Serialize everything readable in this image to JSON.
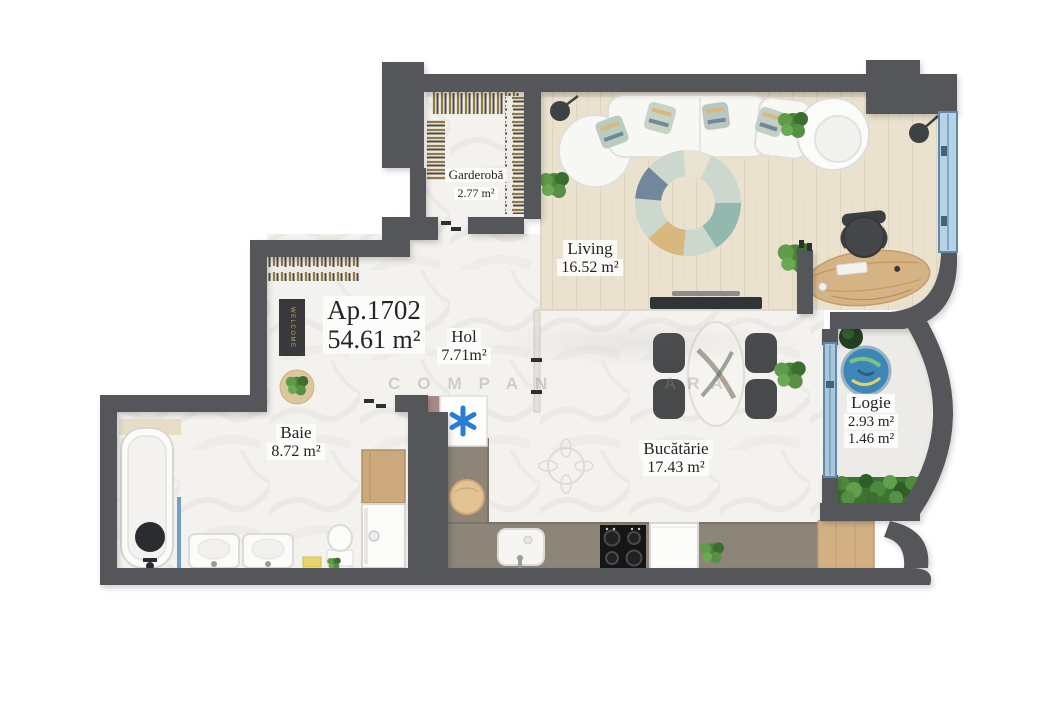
{
  "apartment": {
    "label": "Ap.1702",
    "area": "54.61 m²"
  },
  "rooms": [
    {
      "key": "garderoba",
      "name": "Garderobă",
      "area": "2.77 m²"
    },
    {
      "key": "living",
      "name": "Living",
      "area": "16.52 m²"
    },
    {
      "key": "hol",
      "name": "Hol",
      "area": "7.71m²"
    },
    {
      "key": "baie",
      "name": "Baie",
      "area": "8.72  m²"
    },
    {
      "key": "bucatarie",
      "name": "Bucătărie",
      "area": "17.43 m²"
    },
    {
      "key": "logie",
      "name": "Logie",
      "area": "2.93 m²",
      "area_secondary": "1.46 m²"
    }
  ],
  "labels": {
    "welcome_mat": "WELCOME"
  },
  "watermark": {
    "fragment1": "COMPAN",
    "fragment2": "ARA"
  },
  "icons": {
    "ac_unit": "snowflake-asterisk-icon",
    "openings": "window-glass",
    "greenery": "plant-icon"
  },
  "colors": {
    "wall": "#54575a",
    "window_blue": "#7fa8c9",
    "accent_blue": "#2b7cd3",
    "marble_floor": "#f4f2ef",
    "wood_floor": "#eae2cf",
    "logie_floor": "#ecebe7",
    "counter": "#8d8578",
    "furniture_wood": "#d2b084",
    "greenery": "#4e8a3c",
    "welcome_gold": "#c8a255"
  }
}
